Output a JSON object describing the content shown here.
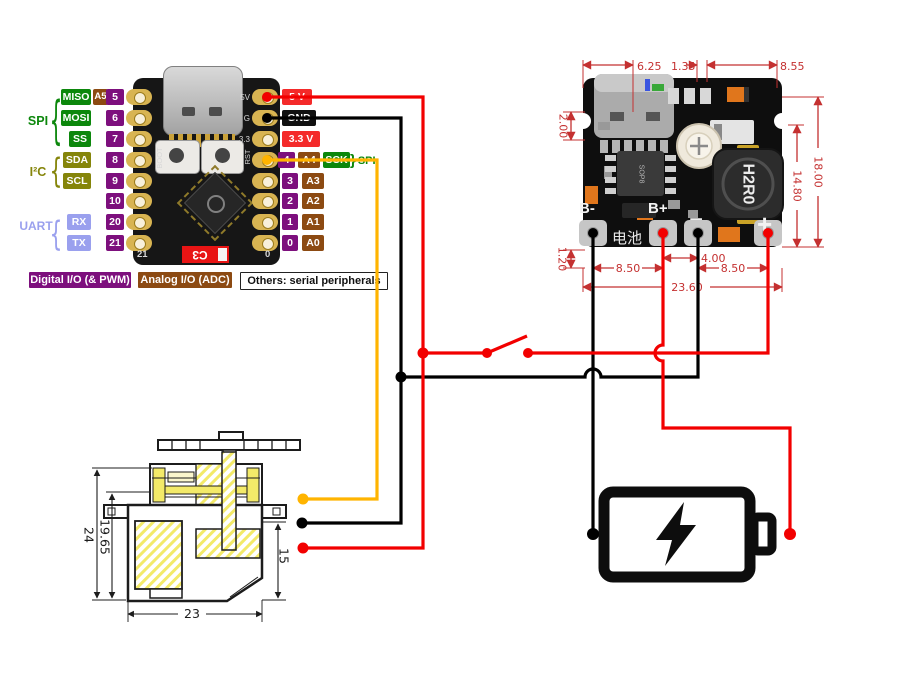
{
  "esp": {
    "brace_left": "{",
    "groups": [
      {
        "label": "SPI"
      },
      {
        "label": "I²C"
      },
      {
        "label": "UART"
      }
    ],
    "left_rows": [
      {
        "protocol": "MISO",
        "analog": "A5",
        "num": "5"
      },
      {
        "protocol": "MOSI",
        "num": "6"
      },
      {
        "protocol": "SS",
        "num": "7"
      },
      {
        "protocol": "SDA",
        "num": "8"
      },
      {
        "protocol": "SCL",
        "num": "9"
      },
      {
        "num": "10"
      },
      {
        "protocol": "RX",
        "num": "20"
      },
      {
        "protocol": "TX",
        "num": "21"
      }
    ],
    "right_rows": [
      {
        "power": "5 V"
      },
      {
        "power": "GND"
      },
      {
        "power": "3.3 V"
      },
      {
        "num": "4",
        "analog": "A4",
        "serial": "SCK",
        "brace": "}",
        "group": "SPI"
      },
      {
        "num": "3",
        "analog": "A3"
      },
      {
        "num": "2",
        "analog": "A2"
      },
      {
        "num": "1",
        "analog": "A1"
      },
      {
        "num": "0",
        "analog": "A0"
      }
    ],
    "board_texts": {
      "pin_5v": "5V",
      "pin_g": "G",
      "pin_33": "3.3",
      "rst": "RST",
      "boot": "BOOT",
      "corner_left": "21",
      "corner_right": "0",
      "chip": "C3"
    },
    "legend": [
      {
        "label": "Digital I/O (& PWM)"
      },
      {
        "label": "Analog I/O (ADC)"
      },
      {
        "label": "Others: serial peripherals"
      }
    ]
  },
  "module": {
    "pads": {
      "b_minus": "B-",
      "b_plus": "B+",
      "minus": "−",
      "plus": "+"
    },
    "battery_text": "电池",
    "inductor": "H2R0",
    "chip": "SOP8",
    "dims": {
      "top_left": "6.25",
      "top_mid": "1.35",
      "top_right": "8.55",
      "left_top": "2.00",
      "left_bottom": "1.20",
      "right_inner": "14.80",
      "right_outer": "18.00",
      "bottom_left": "8.50",
      "bottom_mid": "4.00",
      "bottom_right": "8.50",
      "bottom_total": "23.60"
    }
  },
  "servo": {
    "dims": {
      "height_outer": "24",
      "height_inner": "19.65",
      "height_right": "15",
      "width": "23"
    }
  },
  "colors": {
    "wire_red": "#f20000",
    "wire_black": "#000000",
    "wire_orange": "#ffb400",
    "dim_red": "#c43030",
    "purple": "#7d0f7d",
    "brown": "#8c4a12",
    "green": "#0c870c",
    "olive": "#85850a",
    "lavender": "#9aa0ee",
    "label_red": "#f42a2a"
  }
}
